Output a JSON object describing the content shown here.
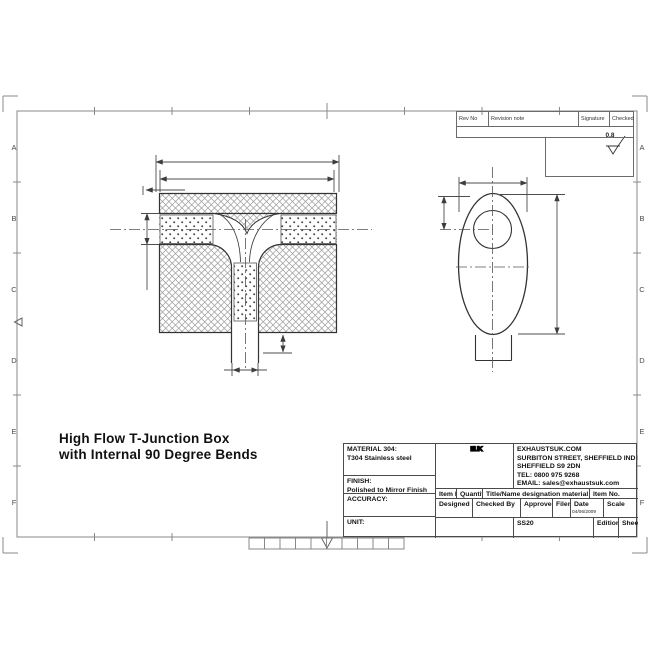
{
  "drawing_title": {
    "line1": "High Flow T-Junction Box",
    "line2": "with Internal 90 Degree Bends"
  },
  "border": {
    "row_labels": [
      "A",
      "B",
      "C",
      "D",
      "E",
      "F"
    ]
  },
  "revision_table": {
    "rev_no": "Rev No",
    "revision_note": "Revision note",
    "signature": "Signature",
    "checked": "Checked"
  },
  "surface_finish": {
    "value": "0.8"
  },
  "title_block": {
    "material_label": "MATERIAL 304:",
    "material_value": "T304 Stainless steel",
    "finish_label": "FINISH:",
    "finish_value": "Polished to Mirror Finish",
    "accuracy_label": "ACCURACY:",
    "unit_label": "UNIT:",
    "logo": "EUK",
    "company": {
      "website": "EXHAUSTSUK.COM",
      "address1": "SURBITON STREET, SHEFFIELD IND EST.,",
      "address2": "SHEFFIELD S9 2DN",
      "tel": "TEL: 0800 975 9268",
      "email": "EMAIL: sales@exhaustsuk.com"
    },
    "item_row": {
      "item_no": "Item No",
      "quantity": "Quantity",
      "designation": "Title/Name designation material dimensions",
      "item_no2": "Item No."
    },
    "approval_row": {
      "designed_by": "Designed By",
      "checked_by": "Checked By",
      "approved_by": "Approved by date",
      "filename": "Filename",
      "date_label": "Date",
      "date_value": "04/06/2009",
      "scale": "Scale"
    },
    "doc_row": {
      "code": "SS20",
      "edition": "Edition",
      "sheet": "Sheet"
    }
  }
}
